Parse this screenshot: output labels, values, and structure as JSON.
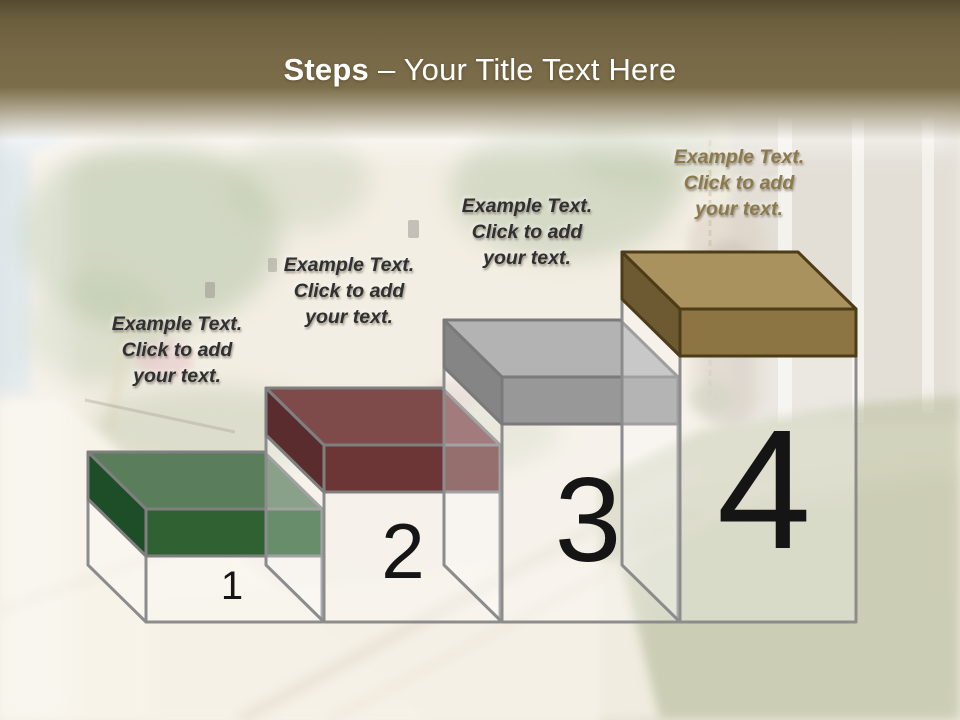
{
  "header": {
    "title_bold": "Steps",
    "title_rest": "– Your Title Text Here",
    "band_color": "#776946",
    "text_color": "#ffffff"
  },
  "pedestal": {
    "stroke": "#8c8c8c"
  },
  "number_color": "#151515",
  "steps": [
    {
      "number": "1",
      "label": {
        "line1": "Example Text.",
        "line2": "Click  to add",
        "line3": "your text.",
        "color": "#303030"
      },
      "box_colors": {
        "top": "#5a7d5b",
        "front": "#2f6132",
        "side": "#1d4e27",
        "outline": "#7f7f7f"
      }
    },
    {
      "number": "2",
      "label": {
        "line1": "Example Text.",
        "line2": "Click  to add",
        "line3": "your text.",
        "color": "#303030"
      },
      "box_colors": {
        "top": "#7f4a4a",
        "front": "#6d3636",
        "side": "#5a2c2e",
        "outline": "#7f7f7f"
      }
    },
    {
      "number": "3",
      "label": {
        "line1": "Example Text.",
        "line2": "Click  to add",
        "line3": "your text.",
        "color": "#303030"
      },
      "box_colors": {
        "top": "#b3b3b3",
        "front": "#989898",
        "side": "#858585",
        "outline": "#7a7a7a"
      }
    },
    {
      "number": "4",
      "label": {
        "line1": "Example Text.",
        "line2": "Click  to add",
        "line3": "your text.",
        "color": "#8b7a4b"
      },
      "box_colors": {
        "top": "#aa925e",
        "front": "#8c7542",
        "side": "#6e5a32",
        "outline": "#4d3c18"
      }
    }
  ]
}
